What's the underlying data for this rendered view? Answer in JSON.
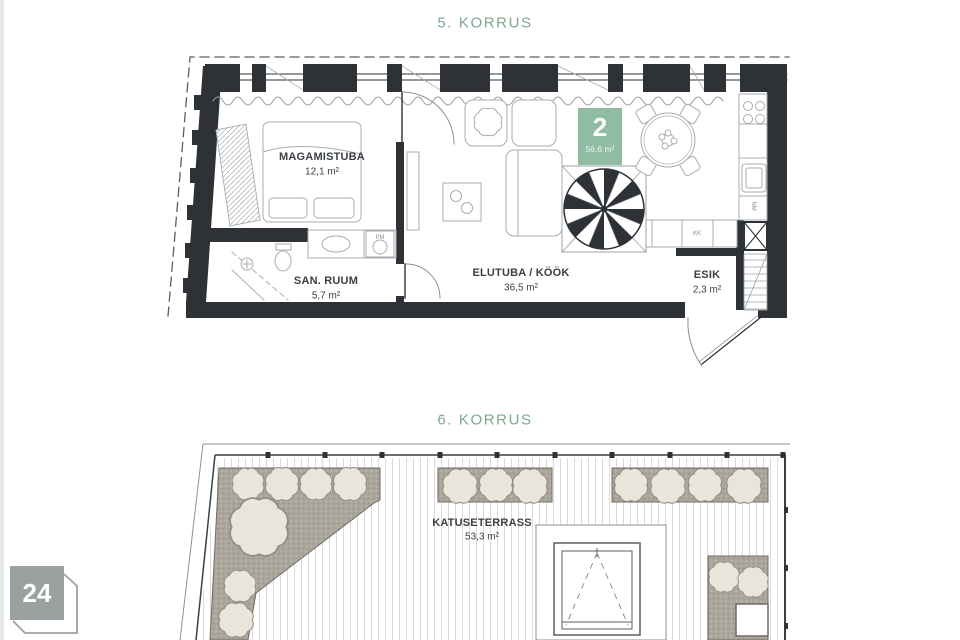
{
  "floor5": {
    "title": "5. KORRUS",
    "unit_badge": {
      "number": "2",
      "area": "56,6 m²"
    },
    "rooms": [
      {
        "name": "MAGAMISTUBA",
        "area": "12,1 m²"
      },
      {
        "name": "SAN. RUUM",
        "area": "5,7 m²"
      },
      {
        "name": "ELUTUBA / KÖÖK",
        "area": "36,5 m²"
      },
      {
        "name": "ESIK",
        "area": "2,3 m²"
      }
    ],
    "fixture_labels": {
      "washing_machine": "PM",
      "closet": "KK",
      "vent": "NM"
    }
  },
  "floor6": {
    "title": "6. KORRUS",
    "rooms": [
      {
        "name": "KATUSETERRASS",
        "area": "53,3 m²"
      }
    ]
  },
  "page_badge": {
    "number": "24"
  },
  "colors": {
    "title_green": "#7CA88F",
    "badge_green": "#90BCA3",
    "wall_dark": "#2E3236",
    "furniture_line": "#A7ADB2",
    "planting_gray": "#ABA69B",
    "bush_beige": "#E9E5DA",
    "deck_line": "#D9D9D7",
    "page_badge_gray": "#9BA0A1",
    "label_dark": "#3B4045"
  }
}
